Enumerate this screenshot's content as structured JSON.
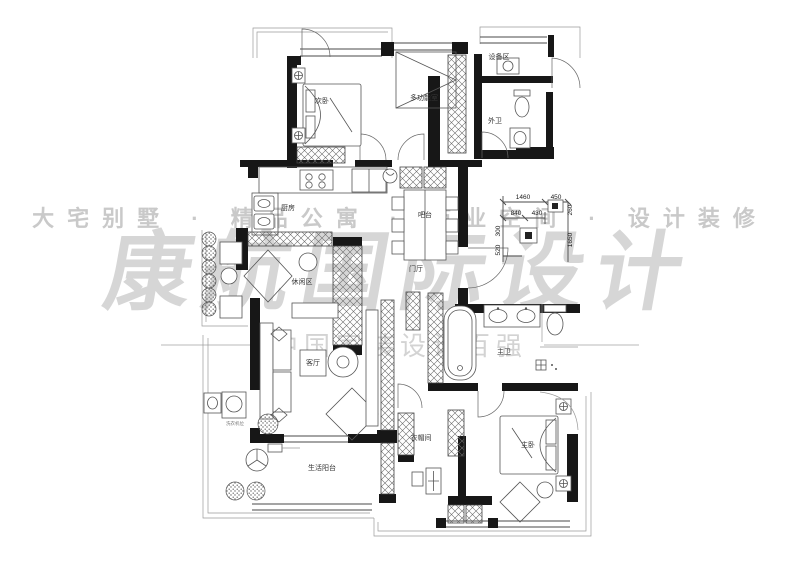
{
  "watermarks": {
    "top": "大宅别墅 · 精品公寓 · 商业空间 · 设计装修",
    "brand": "康航国际设计",
    "bottom": "中国家装设计百强"
  },
  "rooms": {
    "secondary_bedroom": {
      "label": "次卧"
    },
    "multi_function_room": {
      "label": "多功能室"
    },
    "equipment_area": {
      "label": "设备区"
    },
    "guest_bathroom": {
      "label": "外卫"
    },
    "kitchen": {
      "label": "厨房"
    },
    "bar": {
      "label": "吧台"
    },
    "entry_hall": {
      "label": "门厅"
    },
    "leisure_area": {
      "label": "休闲区"
    },
    "living_room": {
      "label": "客厅"
    },
    "master_bathroom": {
      "label": "主卫"
    },
    "cloakroom": {
      "label": "衣帽间"
    },
    "master_bedroom": {
      "label": "主卧"
    },
    "living_balcony": {
      "label": "生活阳台"
    },
    "washer_spot": {
      "label": "洗衣机位"
    }
  },
  "dims": {
    "h1460": "1460",
    "h450": "450",
    "h840": "840",
    "h430": "430",
    "v260": "260",
    "v1650": "1650",
    "v520": "520",
    "v300": "300"
  }
}
